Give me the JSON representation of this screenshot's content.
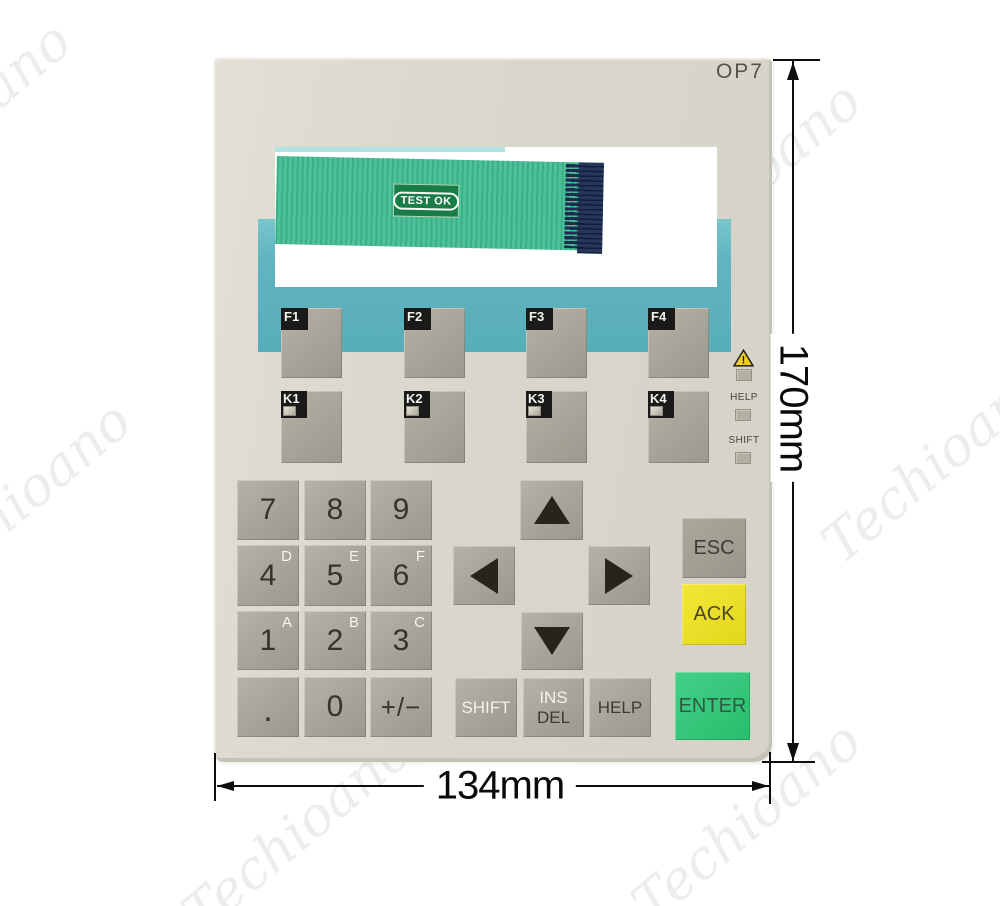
{
  "product": {
    "model": "OP7",
    "test_badge": "TEST OK"
  },
  "dimensions": {
    "width": "134mm",
    "height": "170mm"
  },
  "watermark": {
    "text": "Techioano"
  },
  "function_keys": [
    "F1",
    "F2",
    "F3",
    "F4"
  ],
  "k_keys": [
    "K1",
    "K2",
    "K3",
    "K4"
  ],
  "indicator_labels": {
    "help": "HELP",
    "shift": "SHIFT"
  },
  "numpad": [
    {
      "main": "7",
      "sup": ""
    },
    {
      "main": "8",
      "sup": ""
    },
    {
      "main": "9",
      "sup": ""
    },
    {
      "main": "4",
      "sup": "D"
    },
    {
      "main": "5",
      "sup": "E"
    },
    {
      "main": "6",
      "sup": "F"
    },
    {
      "main": "1",
      "sup": "A"
    },
    {
      "main": "2",
      "sup": "B"
    },
    {
      "main": "3",
      "sup": "C"
    },
    {
      "main": ".",
      "sup": ""
    },
    {
      "main": "0",
      "sup": ""
    },
    {
      "main": "+/−",
      "sup": ""
    }
  ],
  "nav_keys": {
    "shift": "SHIFT",
    "ins": "INS",
    "del": "DEL",
    "help": "HELP"
  },
  "action_keys": {
    "esc": "ESC",
    "ack": "ACK",
    "enter": "ENTER"
  },
  "colors": {
    "panel_beige": "#d9d7cc",
    "band_teal": "#5fb4bf",
    "key_gray": "#a8a499",
    "tab_black": "#1a1a18",
    "ack_yellow": "#ece32b",
    "enter_green": "#35c87c",
    "ribbon_green": "#44ba91",
    "connector_navy": "#1a2747",
    "warning_yellow": "#f2cf1f"
  }
}
